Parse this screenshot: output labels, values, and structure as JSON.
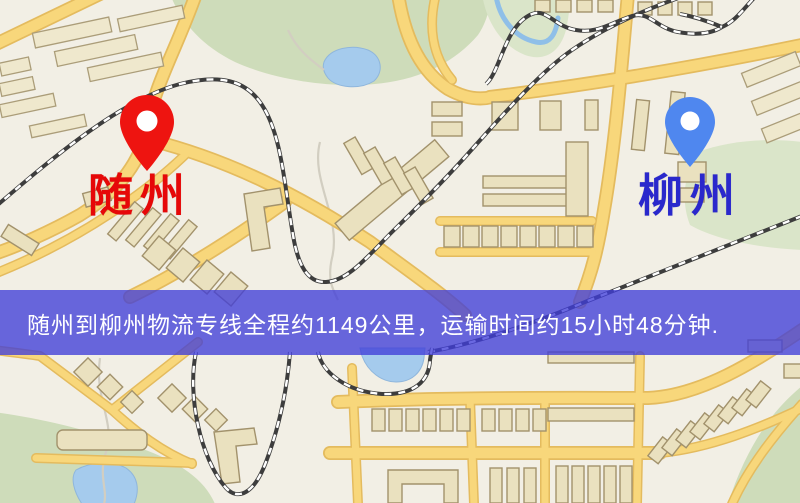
{
  "map": {
    "origin": {
      "label": "随州",
      "pin_color": "#ee1410",
      "label_color": "#e60808"
    },
    "destination": {
      "label": "柳州",
      "pin_color": "#4f87ef",
      "label_color": "#2a28cc"
    },
    "banner": {
      "text": "随州到柳州物流专线全程约1149公里，运输时间约15小时48分钟.",
      "background_color": "#403ed8",
      "text_color": "#ffffff"
    },
    "palette": {
      "map_background": "#f2efe5",
      "road_fill": "#f8d77b",
      "road_casing": "#e4bb5e",
      "building_fill": "#eae1bf",
      "park_fill": "#cedcba",
      "water_fill": "#a5cbed",
      "railway_color": "#3d3d3d"
    }
  }
}
